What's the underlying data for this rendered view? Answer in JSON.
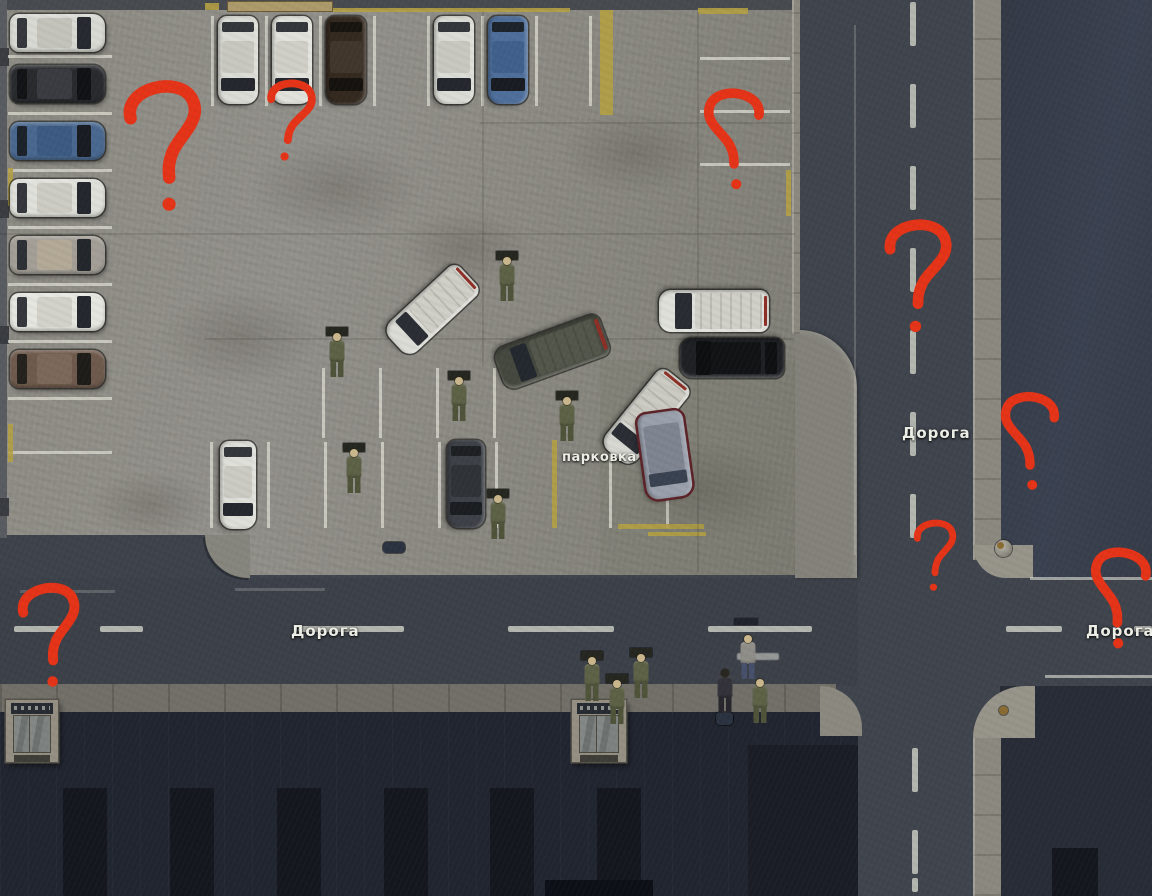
{
  "labels": {
    "road_vertical": "Дорога",
    "road_horizontal_west": "Дорога",
    "road_horizontal_east": "Дорога",
    "parking": "парковка"
  },
  "palette": {
    "annotation_red": "#e53317",
    "asphalt": "#3f444d",
    "lot_gray": "#8b8a82",
    "curb": "#8b897f",
    "building_dark": "#21252f",
    "marking_white": "#d8d8ce",
    "marking_yellow": "#b4a042"
  },
  "scene": {
    "markings": [
      {
        "c": "white",
        "r": [
          8,
          55,
          104,
          3
        ]
      },
      {
        "c": "white",
        "r": [
          8,
          112,
          104,
          3
        ]
      },
      {
        "c": "white",
        "r": [
          8,
          169,
          104,
          3
        ]
      },
      {
        "c": "white",
        "r": [
          8,
          226,
          104,
          3
        ]
      },
      {
        "c": "white",
        "r": [
          8,
          283,
          104,
          3
        ]
      },
      {
        "c": "white",
        "r": [
          8,
          340,
          104,
          3
        ]
      },
      {
        "c": "white",
        "r": [
          8,
          397,
          104,
          3
        ]
      },
      {
        "c": "white",
        "r": [
          8,
          451,
          104,
          3
        ]
      },
      {
        "c": "white",
        "r": [
          211,
          16,
          3,
          90
        ]
      },
      {
        "c": "white",
        "r": [
          265,
          16,
          3,
          90
        ]
      },
      {
        "c": "white",
        "r": [
          319,
          16,
          3,
          90
        ]
      },
      {
        "c": "white",
        "r": [
          373,
          16,
          3,
          90
        ]
      },
      {
        "c": "white",
        "r": [
          427,
          16,
          3,
          90
        ]
      },
      {
        "c": "white",
        "r": [
          481,
          16,
          3,
          90
        ]
      },
      {
        "c": "white",
        "r": [
          535,
          16,
          3,
          90
        ]
      },
      {
        "c": "white",
        "r": [
          589,
          16,
          3,
          90
        ]
      },
      {
        "c": "white",
        "r": [
          700,
          57,
          90,
          3
        ]
      },
      {
        "c": "white",
        "r": [
          700,
          110,
          90,
          3
        ]
      },
      {
        "c": "white",
        "r": [
          700,
          163,
          90,
          3
        ]
      },
      {
        "c": "white",
        "r": [
          322,
          368,
          3,
          70
        ]
      },
      {
        "c": "white",
        "r": [
          379,
          368,
          3,
          70
        ]
      },
      {
        "c": "white",
        "r": [
          436,
          368,
          3,
          70
        ]
      },
      {
        "c": "white",
        "r": [
          493,
          368,
          3,
          70
        ]
      },
      {
        "c": "white",
        "r": [
          210,
          442,
          3,
          86
        ]
      },
      {
        "c": "white",
        "r": [
          267,
          442,
          3,
          86
        ]
      },
      {
        "c": "white",
        "r": [
          324,
          442,
          3,
          86
        ]
      },
      {
        "c": "white",
        "r": [
          381,
          442,
          3,
          86
        ]
      },
      {
        "c": "white",
        "r": [
          438,
          442,
          3,
          86
        ]
      },
      {
        "c": "white",
        "r": [
          495,
          442,
          3,
          86
        ]
      },
      {
        "c": "white",
        "r": [
          609,
          442,
          3,
          86
        ]
      },
      {
        "c": "white",
        "r": [
          666,
          442,
          3,
          86
        ]
      },
      {
        "c": "yellow",
        "r": [
          323,
          8,
          247,
          4
        ]
      },
      {
        "c": "yellow",
        "r": [
          600,
          10,
          13,
          105
        ]
      },
      {
        "c": "yellow",
        "r": [
          698,
          8,
          50,
          6
        ]
      },
      {
        "c": "yellow",
        "r": [
          786,
          170,
          5,
          46
        ]
      },
      {
        "c": "yellow",
        "r": [
          552,
          440,
          5,
          88
        ]
      },
      {
        "c": "yellow",
        "r": [
          618,
          524,
          86,
          5
        ]
      },
      {
        "c": "yellow",
        "r": [
          648,
          532,
          58,
          4
        ]
      },
      {
        "c": "yellow",
        "r": [
          8,
          168,
          5,
          38
        ]
      },
      {
        "c": "yellow",
        "r": [
          8,
          424,
          5,
          38
        ]
      },
      {
        "c": "yellow",
        "r": [
          205,
          3,
          14,
          7
        ]
      },
      {
        "c": "dash",
        "r": [
          910,
          2,
          6,
          44
        ]
      },
      {
        "c": "dash",
        "r": [
          910,
          84,
          6,
          44
        ]
      },
      {
        "c": "dash",
        "r": [
          910,
          166,
          6,
          44
        ]
      },
      {
        "c": "dash",
        "r": [
          910,
          248,
          6,
          44
        ]
      },
      {
        "c": "dash",
        "r": [
          910,
          330,
          6,
          44
        ]
      },
      {
        "c": "dash",
        "r": [
          910,
          412,
          6,
          44
        ]
      },
      {
        "c": "dash",
        "r": [
          910,
          494,
          6,
          44
        ]
      },
      {
        "c": "dash",
        "r": [
          912,
          748,
          6,
          44
        ]
      },
      {
        "c": "dash",
        "r": [
          912,
          830,
          6,
          44
        ]
      },
      {
        "c": "dash",
        "r": [
          912,
          878,
          6,
          14
        ]
      },
      {
        "c": "dash",
        "r": [
          14,
          626,
          48,
          6
        ]
      },
      {
        "c": "dash",
        "r": [
          100,
          626,
          43,
          6
        ]
      },
      {
        "c": "dash",
        "r": [
          298,
          626,
          106,
          6
        ]
      },
      {
        "c": "dash",
        "r": [
          508,
          626,
          106,
          6
        ]
      },
      {
        "c": "dash",
        "r": [
          708,
          626,
          104,
          6
        ]
      },
      {
        "c": "dash",
        "r": [
          1006,
          626,
          56,
          6
        ]
      },
      {
        "c": "dash",
        "r": [
          1134,
          626,
          18,
          6
        ]
      },
      {
        "c": "whitef",
        "r": [
          854,
          25,
          2,
          530
        ]
      },
      {
        "c": "whitef",
        "r": [
          20,
          590,
          95,
          3
        ]
      },
      {
        "c": "whitef",
        "r": [
          235,
          588,
          90,
          3
        ]
      },
      {
        "c": "whiteb",
        "r": [
          1030,
          577,
          122,
          3
        ]
      },
      {
        "c": "whiteb",
        "r": [
          1045,
          675,
          107,
          3
        ]
      },
      {
        "c": "seam",
        "r": [
          0,
          233,
          795,
          2
        ]
      },
      {
        "c": "seam",
        "r": [
          480,
          122,
          315,
          2
        ]
      },
      {
        "c": "seam",
        "r": [
          205,
          338,
          588,
          2
        ]
      },
      {
        "c": "seam",
        "r": [
          482,
          12,
          2,
          355
        ]
      },
      {
        "c": "seam",
        "r": [
          697,
          12,
          2,
          560
        ]
      },
      {
        "c": "stain",
        "r": [
          250,
          140,
          170,
          95
        ]
      },
      {
        "c": "stain",
        "r": [
          560,
          110,
          150,
          85
        ]
      },
      {
        "c": "stain",
        "r": [
          160,
          290,
          160,
          95
        ]
      },
      {
        "c": "stain",
        "r": [
          620,
          440,
          170,
          100
        ]
      },
      {
        "c": "stain",
        "r": [
          400,
          210,
          130,
          75
        ]
      },
      {
        "c": "stain",
        "r": [
          90,
          470,
          120,
          70
        ]
      }
    ],
    "cars": [
      {
        "n": "car-white-1",
        "kind": "sedan",
        "x": 10,
        "y": 14,
        "l": 95,
        "w": 38,
        "a": 0,
        "body": "#d9d9d3",
        "glass": "#262a30",
        "roof": "#c3c3bb"
      },
      {
        "n": "car-black-1",
        "kind": "sedan",
        "x": 10,
        "y": 65,
        "l": 95,
        "w": 38,
        "a": 0,
        "body": "#292a2e",
        "glass": "#101114",
        "roof": "#3a3b41"
      },
      {
        "n": "car-blue-1",
        "kind": "sedan",
        "x": 10,
        "y": 122,
        "l": 95,
        "w": 38,
        "a": 0,
        "body": "#49688f",
        "glass": "#181c22",
        "roof": "#3c5a82"
      },
      {
        "n": "car-white-2",
        "kind": "sedan",
        "x": 10,
        "y": 179,
        "l": 95,
        "w": 38,
        "a": 0,
        "body": "#e0e0da",
        "glass": "#24282e",
        "roof": "#ccccc4"
      },
      {
        "n": "car-silver-1",
        "kind": "sedan",
        "x": 10,
        "y": 236,
        "l": 95,
        "w": 38,
        "a": 0,
        "body": "#a39f97",
        "glass": "#23262b",
        "roof": "#b3a996"
      },
      {
        "n": "car-white-3",
        "kind": "sedan",
        "x": 10,
        "y": 293,
        "l": 95,
        "w": 38,
        "a": 0,
        "body": "#e6e6e0",
        "glass": "#24282e",
        "roof": "#d2d2ca"
      },
      {
        "n": "car-brown-1",
        "kind": "sedan",
        "x": 10,
        "y": 350,
        "l": 95,
        "w": 38,
        "a": 0,
        "body": "#6e5a4c",
        "glass": "#1e1c18",
        "roof": "#7c685a"
      },
      {
        "n": "car-white-4",
        "kind": "sedan",
        "x": 194,
        "y": 40,
        "l": 88,
        "w": 40,
        "a": 90,
        "body": "#dcdcd6",
        "glass": "#24282e",
        "roof": "#c8c8c0"
      },
      {
        "n": "car-white-5",
        "kind": "sedan",
        "x": 248,
        "y": 40,
        "l": 88,
        "w": 40,
        "a": 90,
        "body": "#e2e2dc",
        "glass": "#24282e",
        "roof": "#cfcfc7"
      },
      {
        "n": "car-darkbrown-1",
        "kind": "sedan",
        "x": 302,
        "y": 40,
        "l": 88,
        "w": 40,
        "a": 90,
        "body": "#33291f",
        "glass": "#15120e",
        "roof": "#41362c"
      },
      {
        "n": "car-white-6",
        "kind": "sedan",
        "x": 410,
        "y": 40,
        "l": 88,
        "w": 40,
        "a": 90,
        "body": "#dcdcd6",
        "glass": "#24282e",
        "roof": "#c8c8c0"
      },
      {
        "n": "car-blue-2",
        "kind": "sedan",
        "x": 464,
        "y": 40,
        "l": 88,
        "w": 40,
        "a": 90,
        "body": "#4e6f9b",
        "glass": "#181c22",
        "roof": "#40608c"
      },
      {
        "n": "van-white-angled-1",
        "kind": "van",
        "x": 382,
        "y": 290,
        "l": 100,
        "w": 40,
        "a": 137,
        "body": "#dcdcd6",
        "glass": "#2a2e34",
        "roof": "#cfcfc7"
      },
      {
        "n": "van-dark-1",
        "kind": "van",
        "x": 496,
        "y": 330,
        "l": 112,
        "w": 44,
        "a": 160,
        "body": "#45483e",
        "glass": "#23282e",
        "roof": "#53564a"
      },
      {
        "n": "van-white-2",
        "kind": "van",
        "x": 659,
        "y": 290,
        "l": 110,
        "w": 42,
        "a": 180,
        "body": "#e0e0da",
        "glass": "#282c32",
        "roof": "#d0d0c8"
      },
      {
        "n": "suv-black-1",
        "kind": "suv",
        "x": 680,
        "y": 338,
        "l": 104,
        "w": 40,
        "a": 180,
        "body": "#1e2024",
        "glass": "#0c0e10",
        "roof": "#101214"
      },
      {
        "n": "van-white-angled-2",
        "kind": "van",
        "x": 596,
        "y": 397,
        "l": 100,
        "w": 40,
        "a": 129,
        "body": "#d8d8d2",
        "glass": "#2a2e34",
        "roof": "#cbcbc3"
      },
      {
        "n": "minivan-gray-1",
        "kind": "minivan",
        "x": 622,
        "y": 432,
        "l": 86,
        "w": 46,
        "a": 82,
        "body": "#9aa0ac",
        "glass": "#394250",
        "roof": "#7e8490",
        "trim": "#5c2228"
      },
      {
        "n": "car-white-7",
        "kind": "sedan",
        "x": 194,
        "y": 467,
        "l": 88,
        "w": 36,
        "a": 90,
        "body": "#dfdfd9",
        "glass": "#24282e",
        "roof": "#cbcbc3"
      },
      {
        "n": "car-dark-2",
        "kind": "sedan",
        "x": 422,
        "y": 465,
        "l": 88,
        "w": 38,
        "a": 90,
        "body": "#3d4147",
        "glass": "#1a1d21",
        "roof": "#2f3338"
      }
    ],
    "people": [
      {
        "n": "soldier-1",
        "t": "soldier",
        "x": 498,
        "y": 254,
        "p": 1
      },
      {
        "n": "soldier-2",
        "t": "soldier",
        "x": 328,
        "y": 330,
        "p": 1
      },
      {
        "n": "soldier-3",
        "t": "soldier",
        "x": 450,
        "y": 374,
        "p": 1
      },
      {
        "n": "soldier-4",
        "t": "soldier",
        "x": 558,
        "y": 394,
        "p": 1
      },
      {
        "n": "soldier-5",
        "t": "soldier",
        "x": 345,
        "y": 446,
        "p": 1
      },
      {
        "n": "soldier-6",
        "t": "soldier",
        "x": 489,
        "y": 492,
        "p": 1
      },
      {
        "n": "soldier-7",
        "t": "soldier",
        "x": 583,
        "y": 654,
        "p": 1
      },
      {
        "n": "soldier-8",
        "t": "soldier",
        "x": 608,
        "y": 677,
        "p": 1
      },
      {
        "n": "soldier-9",
        "t": "soldier",
        "x": 632,
        "y": 651,
        "p": 1
      },
      {
        "n": "civilian-1",
        "t": "civ-dark",
        "x": 716,
        "y": 666,
        "p": 0
      },
      {
        "n": "civilian-2",
        "t": "civ-gray",
        "x": 739,
        "y": 632,
        "p": 0
      },
      {
        "n": "soldier-10",
        "t": "soldier",
        "x": 751,
        "y": 676,
        "p": 0
      }
    ],
    "props": [
      {
        "t": "entrance",
        "n": "building-entrance-west",
        "r": [
          6,
          700,
          52,
          62
        ]
      },
      {
        "t": "entrance",
        "n": "building-entrance-center",
        "r": [
          572,
          700,
          54,
          62
        ]
      },
      {
        "t": "bag",
        "n": "duffel-bag",
        "r": [
          383,
          542,
          22,
          11
        ]
      },
      {
        "t": "bag",
        "n": "dropped-bag",
        "r": [
          716,
          712,
          17,
          13
        ]
      },
      {
        "t": "bollard",
        "n": "corner-bollard",
        "r": [
          995,
          540,
          17,
          17
        ]
      },
      {
        "t": "bolt",
        "n": "curb-bolt",
        "r": [
          999,
          706,
          9,
          9
        ]
      },
      {
        "t": "tag",
        "n": "name-tag",
        "r": [
          733,
          617,
          26,
          9
        ]
      },
      {
        "t": "smudge",
        "n": "chat-text-smudge",
        "r": [
          737,
          653,
          42,
          7
        ]
      },
      {
        "t": "sign",
        "n": "lot-wall-sign",
        "r": [
          228,
          2,
          104,
          9
        ]
      }
    ],
    "question_marks": [
      {
        "x": 122,
        "y": 72,
        "w": 88,
        "h": 150,
        "m": 0,
        "rot": -6
      },
      {
        "x": 262,
        "y": 60,
        "w": 55,
        "h": 122,
        "m": 0,
        "rot": 5
      },
      {
        "x": 700,
        "y": 72,
        "w": 68,
        "h": 136,
        "m": 1,
        "rot": 0
      },
      {
        "x": 880,
        "y": 198,
        "w": 76,
        "h": 158,
        "m": 0,
        "rot": 0
      },
      {
        "x": 997,
        "y": 364,
        "w": 66,
        "h": 156,
        "m": 1,
        "rot": 0
      },
      {
        "x": 911,
        "y": 500,
        "w": 48,
        "h": 112,
        "m": 0,
        "rot": 0
      },
      {
        "x": 1085,
        "y": 527,
        "w": 68,
        "h": 144,
        "m": 1,
        "rot": 4
      },
      {
        "x": 16,
        "y": 569,
        "w": 70,
        "h": 134,
        "m": 0,
        "rot": -5
      }
    ]
  }
}
